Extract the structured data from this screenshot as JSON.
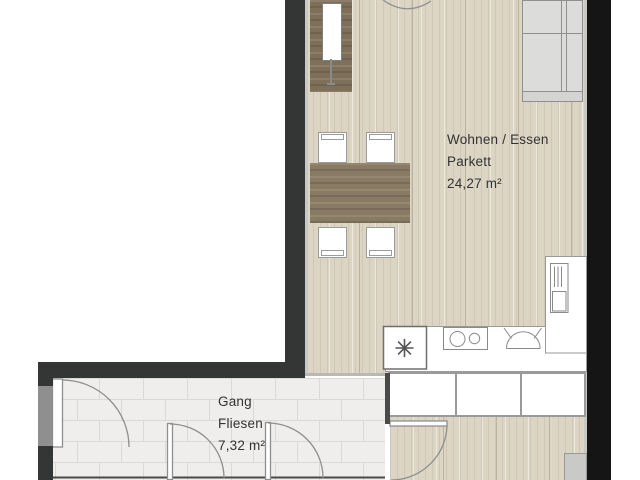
{
  "plan": {
    "rooms": {
      "living": {
        "name": "Wohnen / Essen",
        "floor_type": "Parkett",
        "area": "24,27 m²"
      },
      "hallway": {
        "name": "Gang",
        "floor_type": "Fliesen",
        "area": "7,32 m²"
      }
    },
    "icons": {
      "freezer": "freezer-snowflake-icon",
      "cooktop": "cooktop-burners-icon",
      "sink": "sink-basin-icon",
      "oven": "oven-tall-unit-icon"
    },
    "colors": {
      "wall": "#333635",
      "wall_right": "#151515",
      "parquet_floor": "#dcd5c3",
      "tile_floor": "#efeeec",
      "wood_furniture": "#7e6f59",
      "outline": "#8f8f8f",
      "text": "#333333"
    }
  }
}
